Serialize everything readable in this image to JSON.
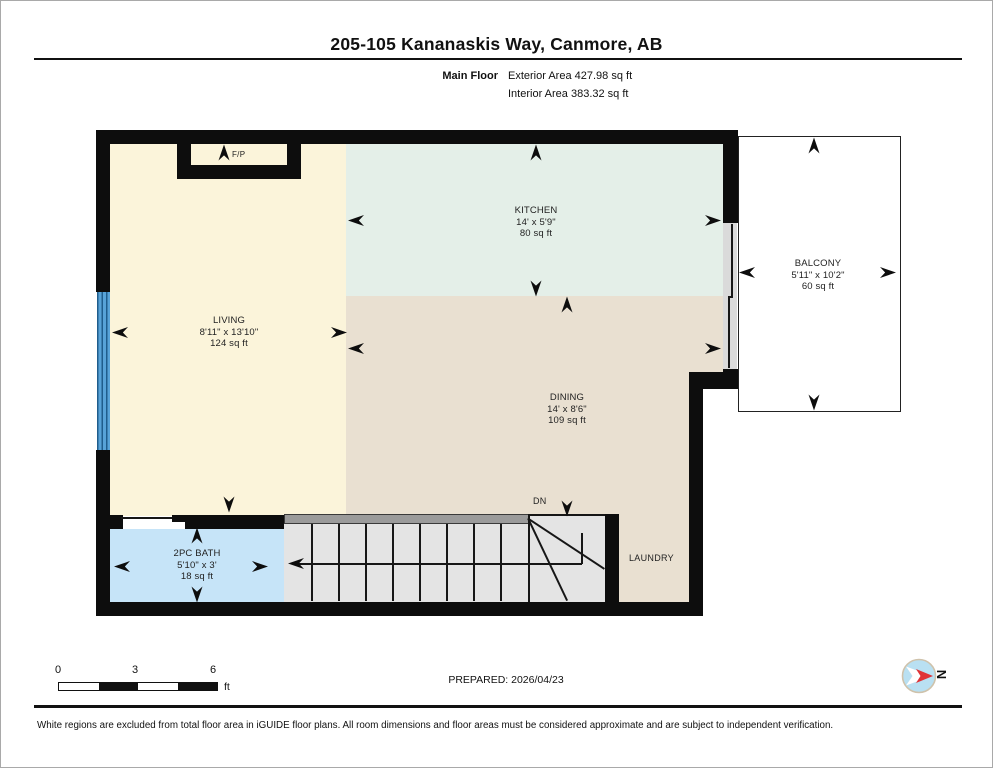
{
  "header": {
    "title": "205-105 Kananaskis Way, Canmore, AB",
    "floor_label": "Main Floor",
    "exterior_area": "Exterior Area 427.98 sq ft",
    "interior_area": "Interior Area 383.32 sq ft"
  },
  "rooms": {
    "living": {
      "name": "LIVING",
      "dims": "8'11\" x 13'10\"",
      "area": "124 sq ft"
    },
    "kitchen": {
      "name": "KITCHEN",
      "dims": "14' x 5'9\"",
      "area": "80 sq ft"
    },
    "dining": {
      "name": "DINING",
      "dims": "14' x 8'6\"",
      "area": "109 sq ft"
    },
    "bath": {
      "name": "2PC BATH",
      "dims": "5'10\" x 3'",
      "area": "18 sq ft"
    },
    "balcony": {
      "name": "BALCONY",
      "dims": "5'11\" x 10'2\"",
      "area": "60 sq ft"
    }
  },
  "labels": {
    "fireplace": "F/P",
    "stairs_down": "DN",
    "laundry": "LAUNDRY"
  },
  "scale_bar": {
    "ticks": [
      "0",
      "3",
      "6"
    ],
    "unit": "ft"
  },
  "compass": {
    "label": "N",
    "needle_color": "#e03236",
    "face_color": "#b9e0f2"
  },
  "footer": {
    "prepared": "PREPARED: 2026/04/23",
    "disclaimer": "White regions are excluded from total floor area in iGUIDE floor plans. All room dimensions and floor areas must be considered approximate and are subject to independent verification."
  },
  "colors": {
    "living": "#fbf4da",
    "kitchen": "#e4efe8",
    "dining": "#e9e0d1",
    "bath": "#c6e4f8",
    "stairs": "#e4e4e4",
    "wall": "#0d0d0d",
    "window": "#58a3d8"
  }
}
